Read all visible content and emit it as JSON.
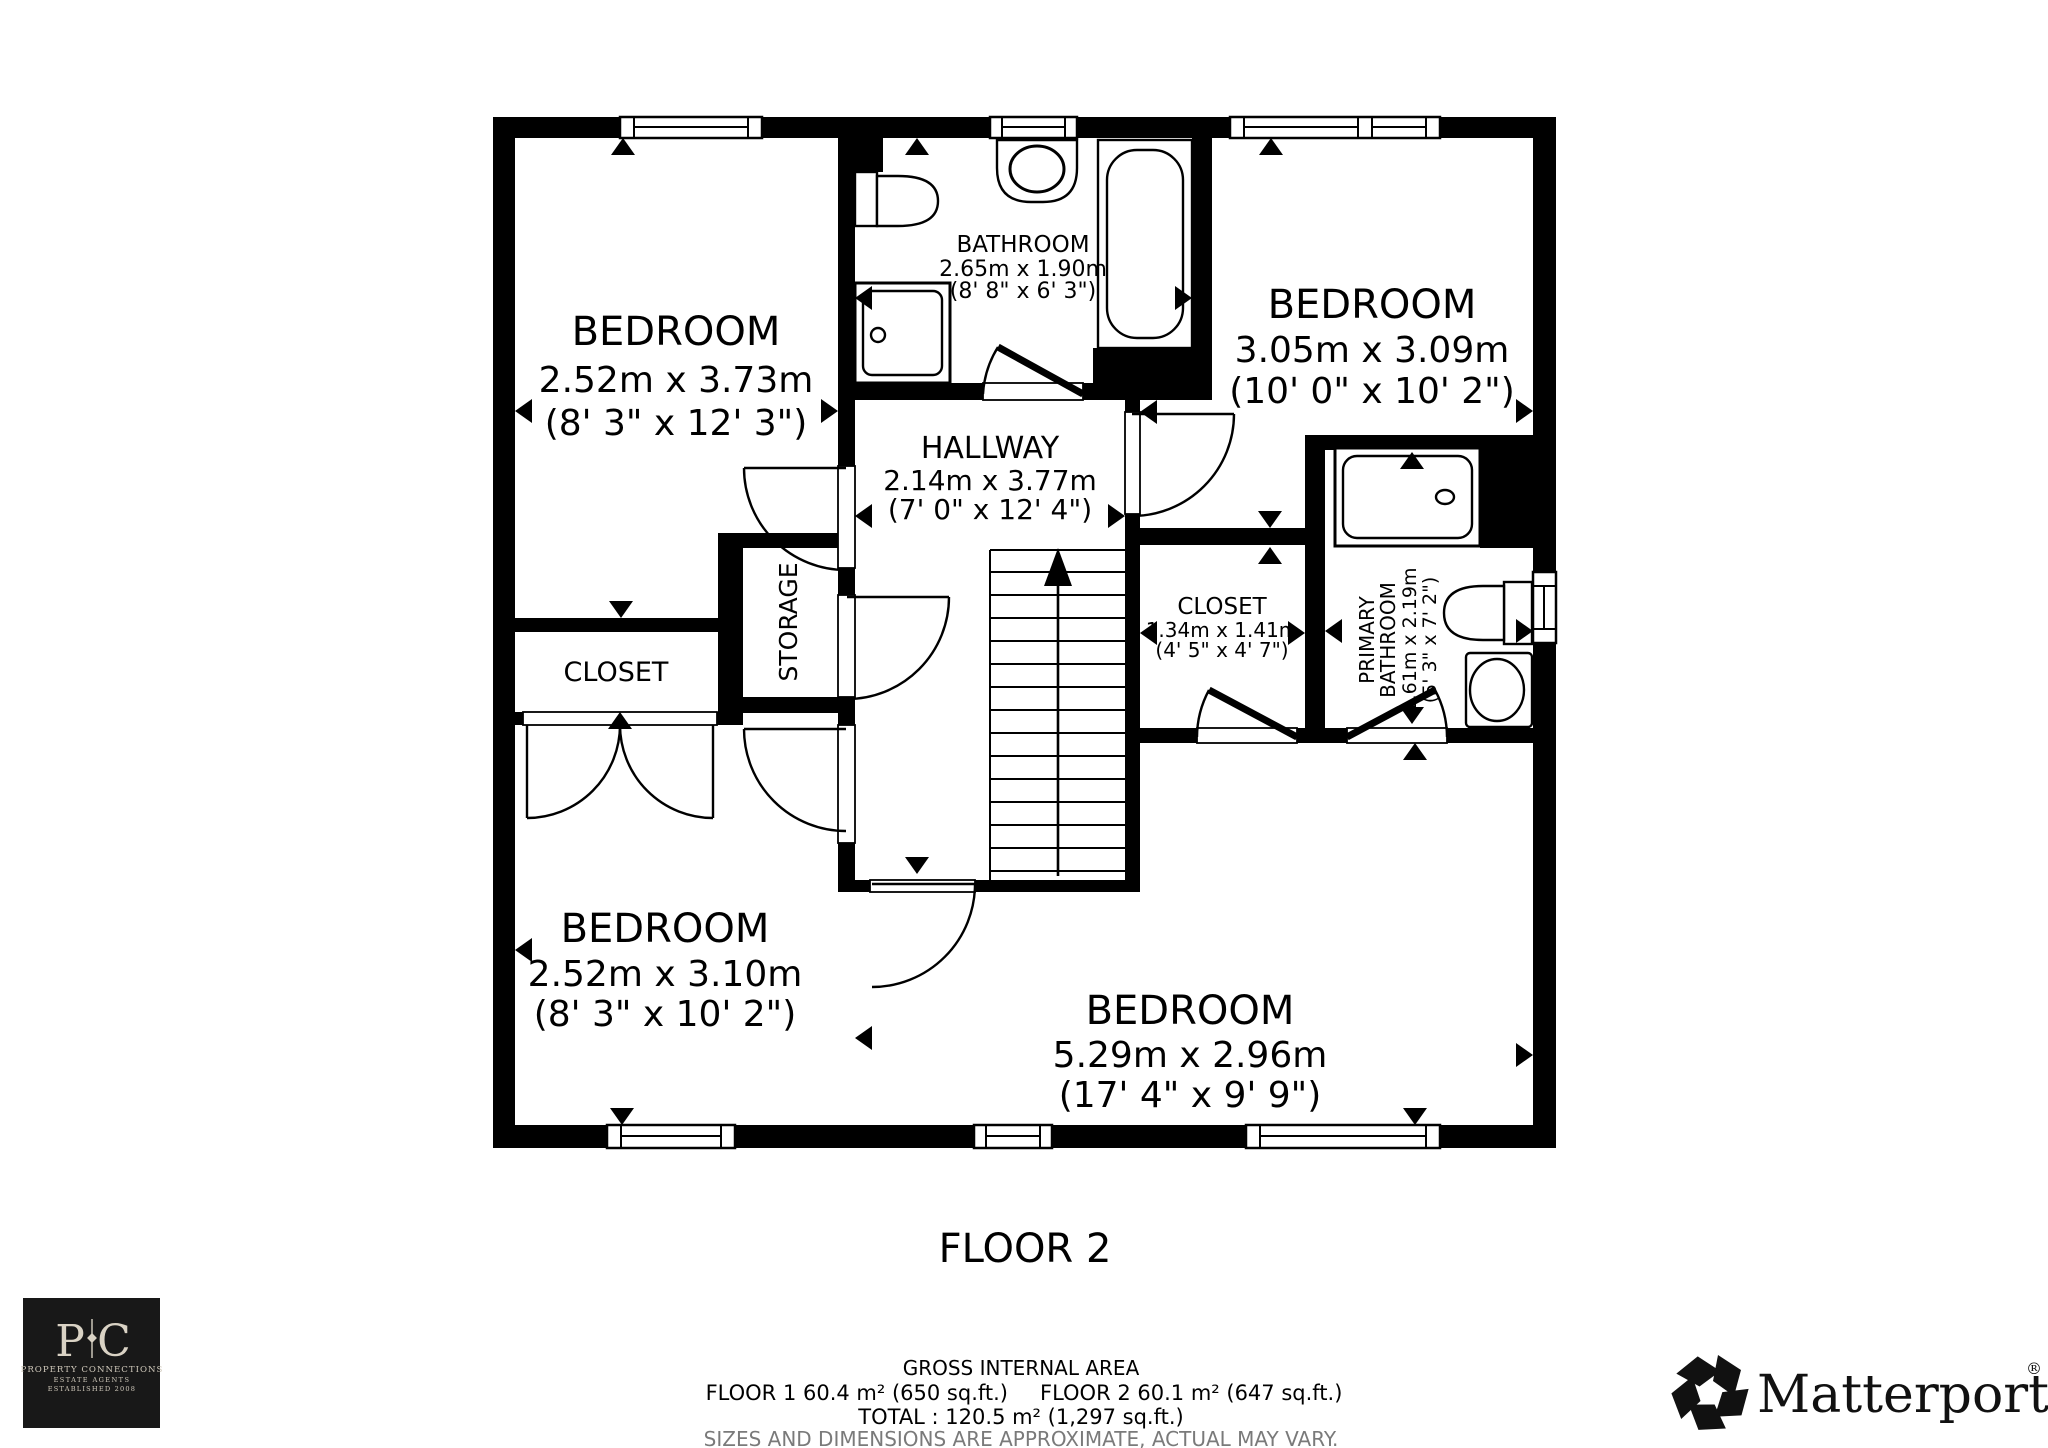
{
  "floor_label": "FLOOR 2",
  "rooms": {
    "bedroom_top_left": {
      "name": "BEDROOM",
      "dim_m": "2.52m x 3.73m",
      "dim_ft": "(8' 3\" x 12' 3\")"
    },
    "bathroom": {
      "name": "BATHROOM",
      "dim_m": "2.65m x 1.90m",
      "dim_ft": "(8' 8\" x 6' 3\")"
    },
    "bedroom_top_right": {
      "name": "BEDROOM",
      "dim_m": "3.05m x 3.09m",
      "dim_ft": "(10' 0\" x 10' 2\")"
    },
    "hallway": {
      "name": "HALLWAY",
      "dim_m": "2.14m x 3.77m",
      "dim_ft": "(7' 0\" x 12' 4\")"
    },
    "closet_left": {
      "name": "CLOSET"
    },
    "storage": {
      "name": "STORAGE"
    },
    "closet_mid": {
      "name": "CLOSET",
      "dim_m": "1.34m x 1.41m",
      "dim_ft": "(4' 5\" x 4' 7\")"
    },
    "primary_bathroom": {
      "name_line1": "PRIMARY",
      "name_line2": "BATHROOM",
      "dim_m": "1.61m x 2.19m",
      "dim_ft": "(5' 3\" x 7' 2\")"
    },
    "bedroom_bottom_left": {
      "name": "BEDROOM",
      "dim_m": "2.52m x 3.10m",
      "dim_ft": "(8' 3\" x 10' 2\")"
    },
    "bedroom_bottom": {
      "name": "BEDROOM",
      "dim_m": "5.29m x 2.96m",
      "dim_ft": "(17' 4\" x 9' 9\")"
    }
  },
  "footer": {
    "title": "GROSS INTERNAL AREA",
    "floor1": "FLOOR 1 60.4 m² (650 sq.ft.)",
    "floor2": "FLOOR 2 60.1 m² (647 sq.ft.)",
    "total": "TOTAL :  120.5 m² (1,297 sq.ft.)",
    "disclaimer": "SIZES AND DIMENSIONS ARE APPROXIMATE, ACTUAL MAY VARY."
  },
  "branding": {
    "agency": {
      "initial_left": "P",
      "initial_right": "C",
      "name": "PROPERTY CONNECTIONS",
      "tagline1": "ESTATE AGENTS",
      "tagline2": "ESTABLISHED 2008"
    },
    "matterport": {
      "name": "Matterport",
      "reg": "®"
    }
  },
  "colors": {
    "ink": "#000000",
    "disclaimer_gray": "#7a7a7a",
    "logo_bg": "#181818",
    "logo_fg": "#d9d2c4"
  }
}
